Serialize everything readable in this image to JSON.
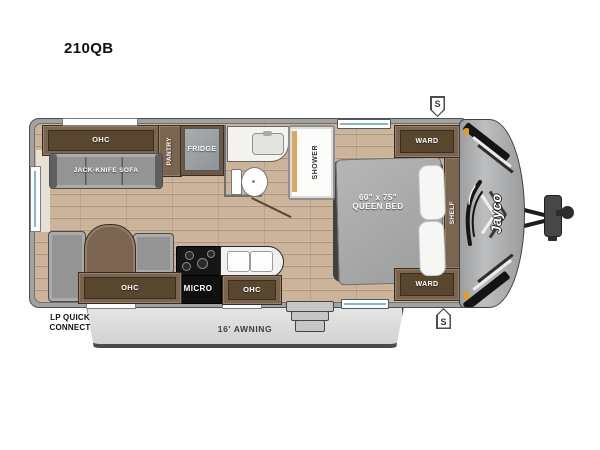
{
  "title": "210QB",
  "plan": {
    "rear_ohc": "OHC",
    "sofa": "JACK-KNIFE SOFA",
    "pantry": "PANTRY",
    "fridge": "FRIDGE",
    "shower": "SHOWER",
    "bed": {
      "size": "60\" x 75\"",
      "name": "QUEEN BED"
    },
    "ward_top": "WARD",
    "ward_bottom": "WARD",
    "shelf": "SHELF",
    "dinette_ohc": "OHC",
    "micro": "MICRO",
    "kitchen_ohc": "OHC",
    "awning": "16' AWNING",
    "lp_quick_connect": [
      "LP QUICK",
      "CONNECT"
    ],
    "stabilizer_top": "S",
    "stabilizer_bottom": "S",
    "brand": "Jayco"
  },
  "colors": {
    "wood_floor": "#cbb499",
    "cabinet_brown": "#7b6450",
    "wall_gray": "#a2a2a2",
    "awning_gray": "#dedede",
    "accent_orange": "#f09a12",
    "shower_gold": "#d7aa60"
  }
}
